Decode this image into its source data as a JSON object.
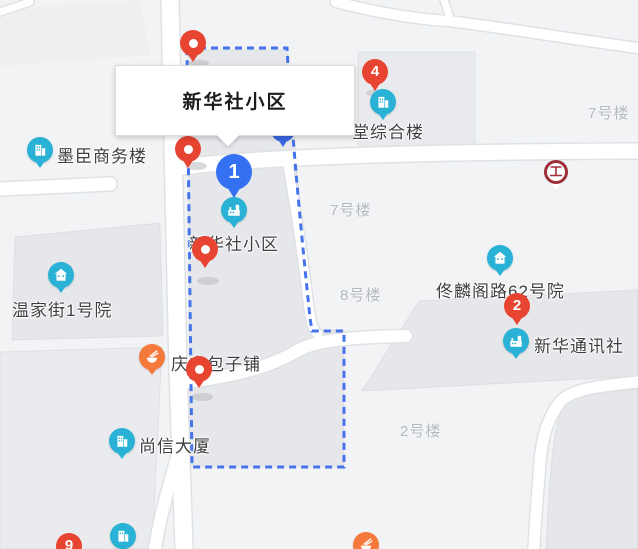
{
  "map": {
    "popup": {
      "title": "新华社小区"
    },
    "poi_labels": [
      {
        "name": "墨臣商务楼"
      },
      {
        "name": "温家街1号院"
      },
      {
        "name": "尚信大厦"
      },
      {
        "name": "庆丰包子铺"
      },
      {
        "name": "新华社小区"
      },
      {
        "name": "堂综合楼"
      },
      {
        "name": "佟麟阁路62号院"
      },
      {
        "name": "新华通讯社"
      }
    ],
    "building_labels": [
      {
        "name": "7号楼"
      },
      {
        "name": "7号楼"
      },
      {
        "name": "8号楼"
      },
      {
        "name": "2号楼"
      }
    ],
    "numbered_markers": [
      {
        "number": "1",
        "color": "blue"
      },
      {
        "number": "2",
        "color": "red"
      },
      {
        "number": "4",
        "color": "red"
      },
      {
        "number": "9",
        "color": "red"
      }
    ],
    "icons": {
      "bank_glyph": "工",
      "poi_icon_types": "office-building, house, factory, restaurant, bank"
    },
    "colors": {
      "marker_red": "#e74431",
      "marker_blue": "#3470f2",
      "poi_teal": "#29b2d5",
      "poi_orange": "#f4793b",
      "boundary_blue": "#4473ea",
      "bank_red": "#9d2f39",
      "building_fill": "#e6e8eb",
      "road_white": "#ffffff",
      "background": "#f2f3f5"
    }
  }
}
